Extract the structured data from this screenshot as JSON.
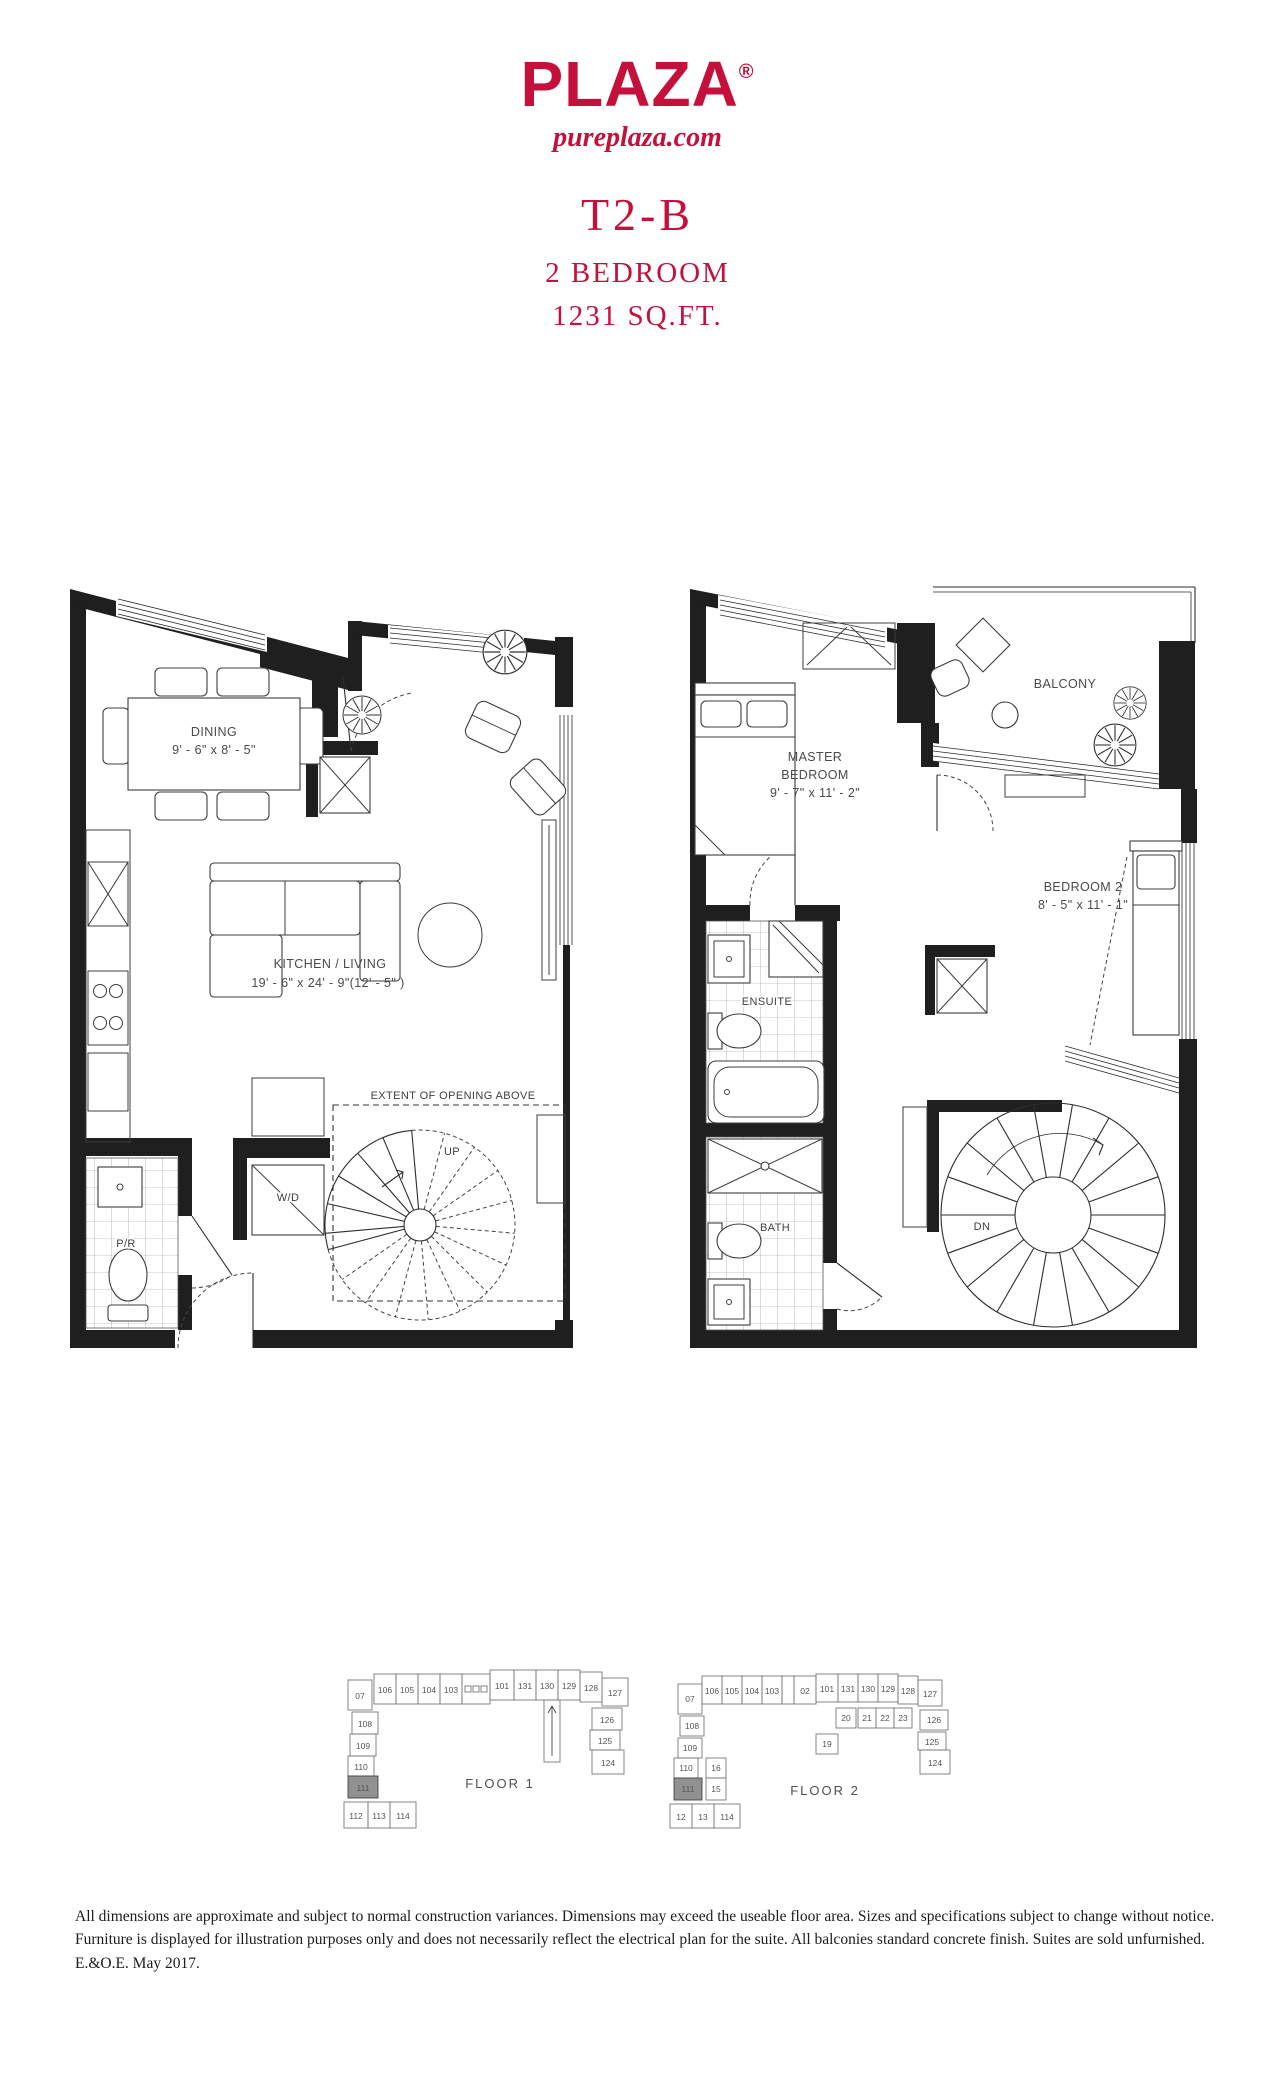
{
  "header": {
    "brand": "PLAZA",
    "registered_mark": "®",
    "website": "pureplaza.com",
    "model": "T2-B",
    "type": "2 BEDROOM",
    "area": "1231 SQ.FT.",
    "accent_color": "#C4113C"
  },
  "plan_floor1": {
    "dining": {
      "name": "DINING",
      "dims": "9' - 6\" x  8' - 5\""
    },
    "kitchen_living": {
      "name": "KITCHEN / LIVING",
      "dims": "19' - 6\" x 24' - 9\"(12' - 5\" )"
    },
    "powder_room": "P/R",
    "washer_dryer": "W/D",
    "stairs_up": "UP",
    "extent_note": "EXTENT OF OPENING ABOVE"
  },
  "plan_floor2": {
    "master_line1": "MASTER",
    "master_line2": "BEDROOM",
    "master_dims": "9' - 7\" x 11' - 2\"",
    "balcony": "BALCONY",
    "bedroom2": "BEDROOM 2",
    "bedroom2_dims": "8' - 5\" x 11' - 1\"",
    "ensuite": "ENSUITE",
    "bath": "BATH",
    "stairs_down": "DN"
  },
  "keyplans": {
    "floor1": {
      "label": "FLOOR 1",
      "highlighted_unit": "111",
      "units": [
        "07",
        "106",
        "105",
        "104",
        "103",
        "101",
        "131",
        "130",
        "129",
        "128",
        "127",
        "126",
        "125",
        "124",
        "108",
        "109",
        "110",
        "111",
        "112",
        "113",
        "114"
      ]
    },
    "floor2": {
      "label": "FLOOR 2",
      "highlighted_unit": "111",
      "units": [
        "07",
        "106",
        "105",
        "104",
        "103",
        "02",
        "101",
        "131",
        "130",
        "129",
        "128",
        "127",
        "126",
        "125",
        "124",
        "20",
        "21",
        "22",
        "23",
        "19",
        "108",
        "109",
        "110",
        "111",
        "16",
        "15",
        "12",
        "13",
        "114"
      ]
    }
  },
  "disclaimer": "All dimensions are approximate and subject to normal construction variances. Dimensions may exceed the useable floor area. Sizes and specifications subject to change without notice. Furniture is displayed for illustration purposes only and does not necessarily reflect the electrical plan for the suite. All balconies standard concrete finish. Suites are sold unfurnished. E.&O.E. May 2017."
}
